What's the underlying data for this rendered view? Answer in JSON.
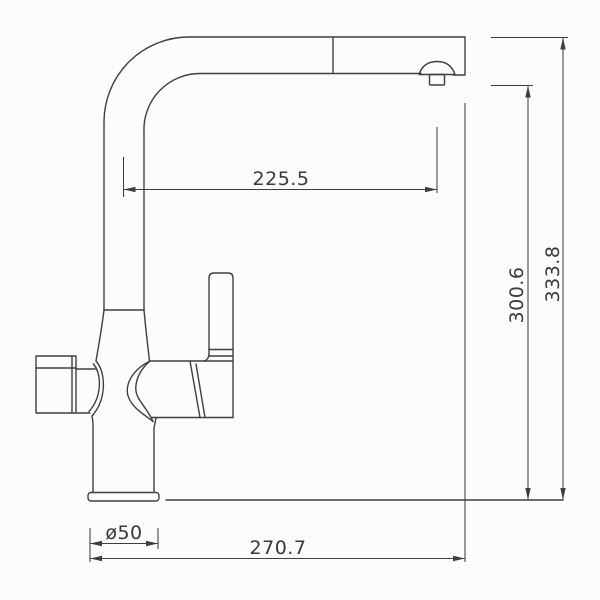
{
  "drawing": {
    "type": "faucet-technical-drawing",
    "dimensions": {
      "spout_reach": "225.5",
      "outlet_height": "300.6",
      "overall_height": "333.8",
      "base_diameter": "ø50",
      "overall_reach": "270.7"
    }
  },
  "colors": {
    "background": "#fcfcfc",
    "line": "#3f3f3f",
    "text": "#3a3a3a"
  }
}
